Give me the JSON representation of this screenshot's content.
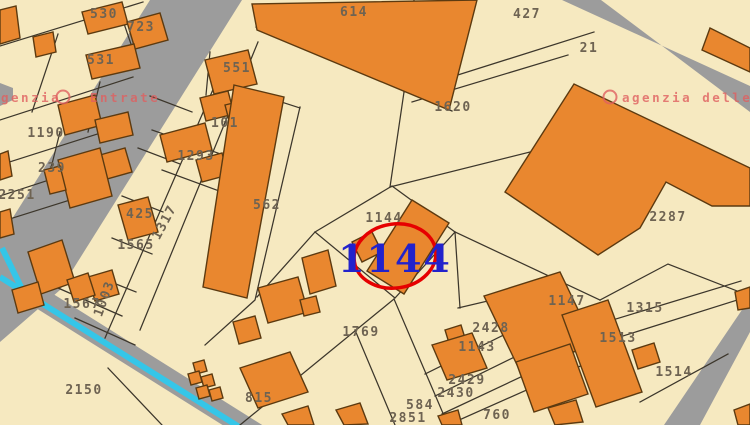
{
  "map": {
    "colors": {
      "background": "#f6e9c0",
      "building": "#e9872f",
      "building_border": "#5c3a10",
      "boundary": "#3c362b",
      "road": "#9c9c9c",
      "water": "#35c6e8",
      "label": "#6e6352",
      "highlight_text": "#2222cc",
      "highlight_ring": "#e60000",
      "watermark": "#e06060"
    },
    "highlight": {
      "parcel": "1144"
    },
    "watermark": {
      "left_fragment_1": "genzia",
      "left_fragment_2": "Entrate",
      "right_fragment": "agenzia delle"
    },
    "parcels": [
      {
        "label": "530",
        "x": 104,
        "y": 18
      },
      {
        "label": "723",
        "x": 141,
        "y": 31
      },
      {
        "label": "531",
        "x": 101,
        "y": 64
      },
      {
        "label": "1190",
        "x": 46,
        "y": 137
      },
      {
        "label": "239",
        "x": 52,
        "y": 172
      },
      {
        "label": "2251",
        "x": 17,
        "y": 199
      },
      {
        "label": "425",
        "x": 140,
        "y": 218
      },
      {
        "label": "1565",
        "x": 136,
        "y": 249
      },
      {
        "label": "1317",
        "x": 168,
        "y": 224,
        "rot": -62
      },
      {
        "label": "1003",
        "x": 108,
        "y": 300,
        "rot": -70
      },
      {
        "label": "1567",
        "x": 82,
        "y": 308
      },
      {
        "label": "2150",
        "x": 84,
        "y": 394
      },
      {
        "label": "551",
        "x": 237,
        "y": 72
      },
      {
        "label": "101",
        "x": 225,
        "y": 127
      },
      {
        "label": "1293",
        "x": 196,
        "y": 160
      },
      {
        "label": "562",
        "x": 267,
        "y": 209
      },
      {
        "label": "614",
        "x": 354,
        "y": 16
      },
      {
        "label": "427",
        "x": 527,
        "y": 18
      },
      {
        "label": "21",
        "x": 589,
        "y": 52
      },
      {
        "label": "1620",
        "x": 453,
        "y": 111
      },
      {
        "label": "1144",
        "x": 384,
        "y": 222
      },
      {
        "label": "2287",
        "x": 668,
        "y": 221
      },
      {
        "label": "1147",
        "x": 567,
        "y": 305
      },
      {
        "label": "1315",
        "x": 645,
        "y": 312
      },
      {
        "label": "1513",
        "x": 618,
        "y": 342
      },
      {
        "label": "1514",
        "x": 674,
        "y": 376
      },
      {
        "label": "1769",
        "x": 361,
        "y": 336
      },
      {
        "label": "2428",
        "x": 491,
        "y": 332
      },
      {
        "label": "1143",
        "x": 477,
        "y": 351
      },
      {
        "label": "2429",
        "x": 467,
        "y": 384
      },
      {
        "label": "2430",
        "x": 456,
        "y": 397
      },
      {
        "label": "584",
        "x": 420,
        "y": 409
      },
      {
        "label": "2851",
        "x": 408,
        "y": 422
      },
      {
        "label": "760",
        "x": 497,
        "y": 419
      },
      {
        "label": "815",
        "x": 259,
        "y": 402
      }
    ]
  }
}
